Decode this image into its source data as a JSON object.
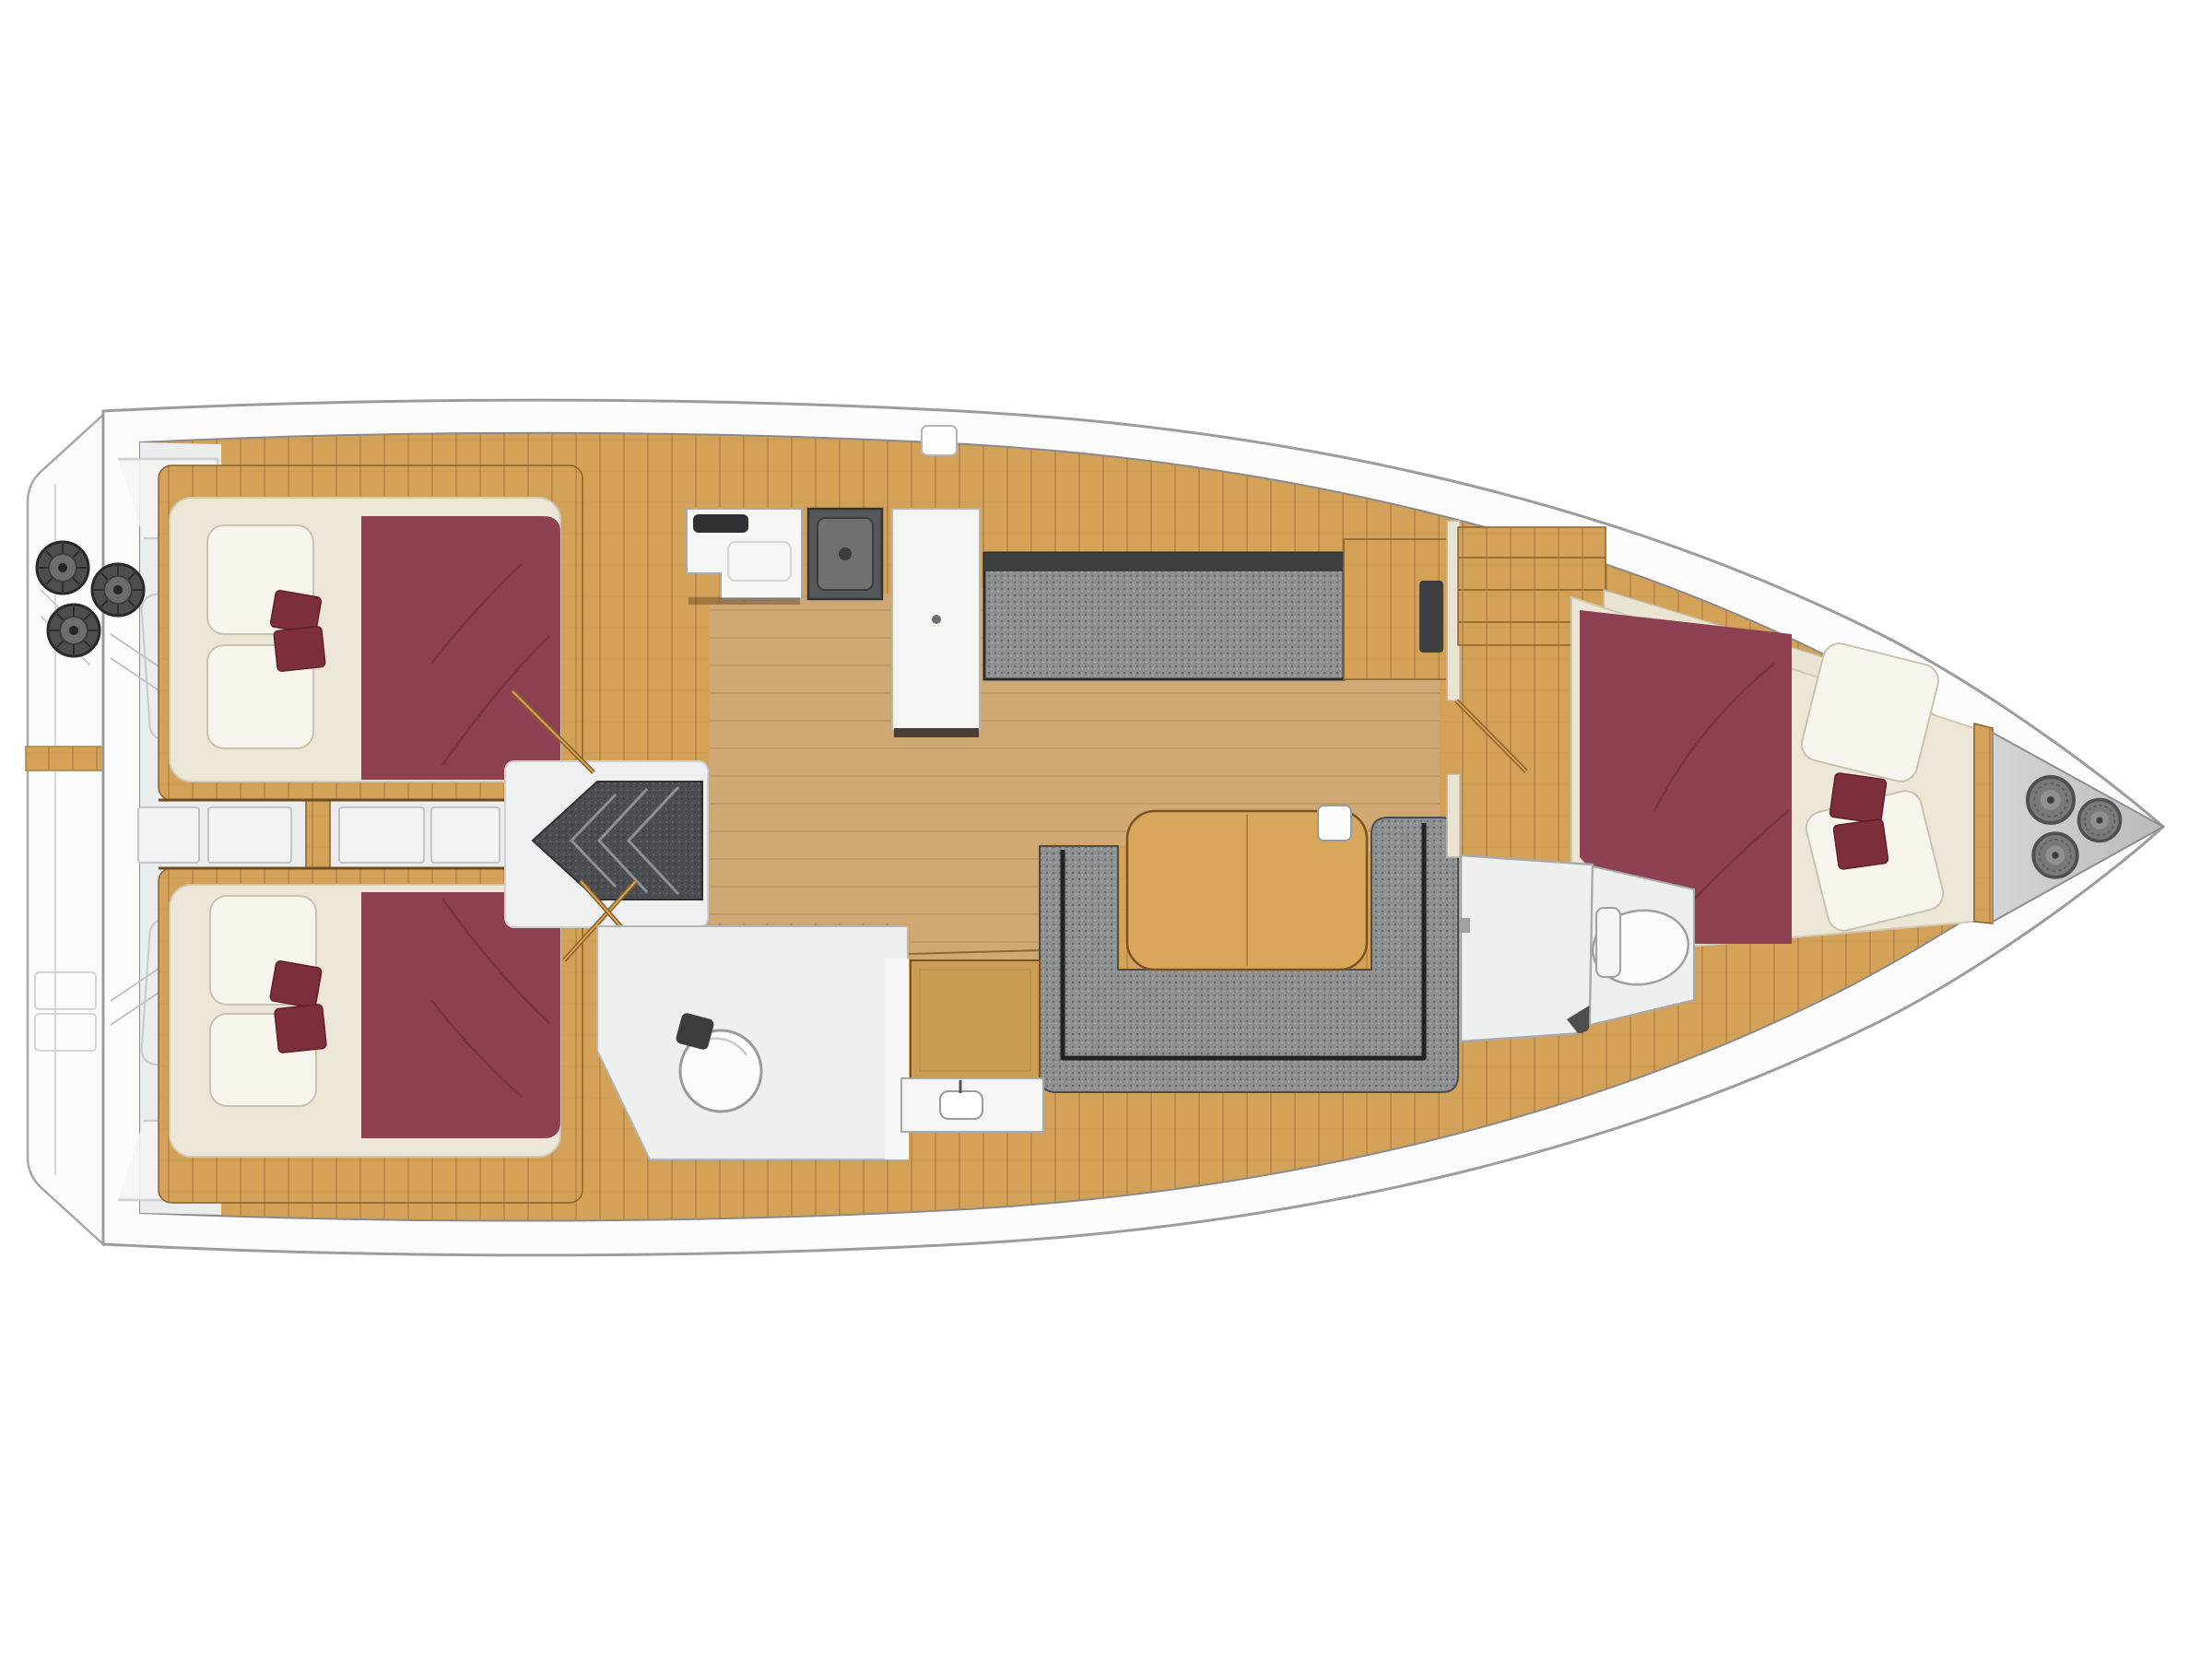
{
  "meta": {
    "label": "Sailing yacht interior floor plan, top-down deck layout with three cabins, salon, galley and two bathrooms"
  },
  "colors": {
    "background": "#ffffff",
    "hull": "#fcfcfd",
    "hullOutline": "#9b9c9e",
    "platform": "#fafbfb",
    "deck": "#d4a159",
    "deckLine": "#8a6228",
    "salonFloor": "#cfa873",
    "cockpit": "#ebecee",
    "corridorBox": "#f2f3f4",
    "mattress": "#ebe6d5",
    "mattressEdge": "#cfc9b4",
    "pillow": "#f6f4ec",
    "pillowEdge": "#c9c3ae",
    "duvet": "#8d4051",
    "duvetFold": "#6f2e3f",
    "cushion": "#7d2e3b",
    "sofa": "#8d9093",
    "sofaSeam": "#202224",
    "steps": "#4a4e52",
    "stepTread": "#8d9196",
    "counter": "#f5f5f4",
    "counterEdge": "#aaaaaa",
    "stove": "#55575a",
    "stoveInner": "#6e7072",
    "sink": "#2f3133",
    "fixture": "#fbfbfc",
    "fixtureEdge": "#98999b",
    "headFloor": "#eef0f0",
    "wall": "#e9e3d2",
    "doorWood": "#c99e52",
    "doorEdge": "#7a5326",
    "winch": "#4c4e50",
    "winchInner": "#6b6d70",
    "forepeakLight": "#d4d5d7",
    "forepeakDark": "#b9babd",
    "coil": "#77797c",
    "coilEdge": "#4e5052",
    "table": "#d9a75c",
    "tableEdge": "#7d5222"
  },
  "regions": [
    {
      "id": "swim-platform",
      "label": "Swim platform / transom"
    },
    {
      "id": "cockpit",
      "label": "Cockpit with winches"
    },
    {
      "id": "aft-cabin-port",
      "label": "Aft double cabin (port)"
    },
    {
      "id": "aft-cabin-starboard",
      "label": "Aft double cabin (starboard)"
    },
    {
      "id": "companionway",
      "label": "Companionway steps"
    },
    {
      "id": "galley",
      "label": "Galley with sink, stove and fridge"
    },
    {
      "id": "aft-head",
      "label": "Aft bathroom with toilet and basin"
    },
    {
      "id": "salon",
      "label": "Salon with U-settee and table"
    },
    {
      "id": "port-settee",
      "label": "Port straight settee"
    },
    {
      "id": "forward-head",
      "label": "Forward bathroom / shower"
    },
    {
      "id": "forward-cabin",
      "label": "Forward double cabin"
    },
    {
      "id": "forepeak",
      "label": "Anchor locker with rope coils"
    }
  ],
  "counts": {
    "winches": 3,
    "ropeCoils": 3,
    "cabins": 3,
    "heads": 2,
    "redCushions": 3
  }
}
